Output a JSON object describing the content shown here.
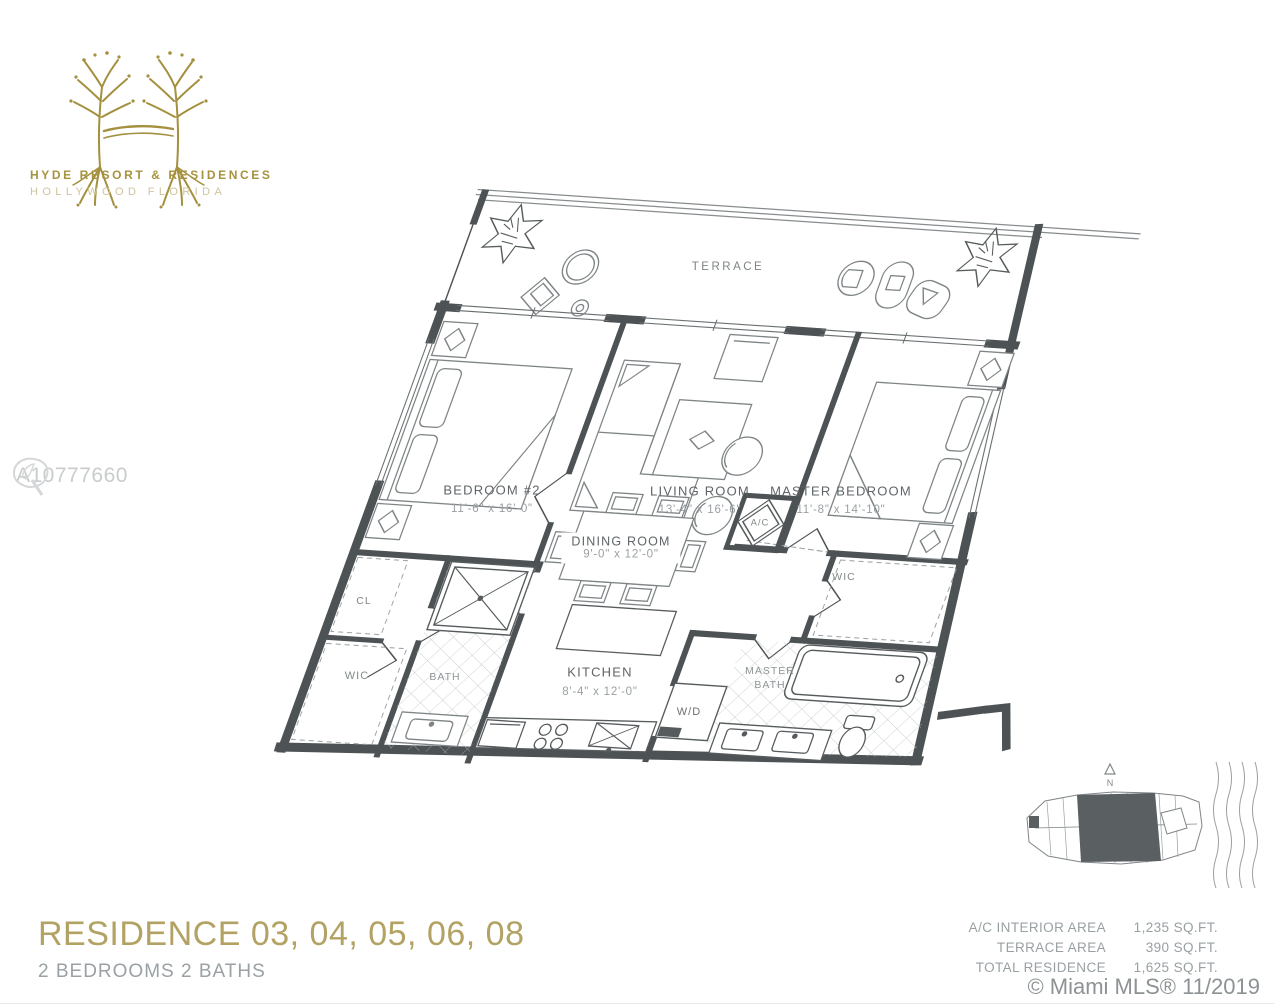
{
  "brand": {
    "line1": "HYDE RESORT & RESIDENCES",
    "line2": "HOLLYWOOD FLORIDA"
  },
  "watermark": {
    "id": "A10777660"
  },
  "plan": {
    "terrace": {
      "label": "TERRACE"
    },
    "bedroom2": {
      "label": "BEDROOM #2",
      "dims": "11'-6\" x 16'-0\""
    },
    "living": {
      "label": "LIVING ROOM",
      "dims": "13'-4\" x 16'-6\""
    },
    "master": {
      "label": "MASTER BEDROOM",
      "dims": "11'-8\" x 14'-10\""
    },
    "dining": {
      "label": "DINING ROOM",
      "dims": "9'-0\" x 12'-0\""
    },
    "kitchen": {
      "label": "KITCHEN",
      "dims": "8'-4\" x 12'-0\""
    },
    "cl": {
      "label": "CL"
    },
    "wic_left": {
      "label": "WIC"
    },
    "bath": {
      "label": "BATH"
    },
    "master_bath": {
      "line1": "MASTER",
      "line2": "BATH"
    },
    "wic_master": {
      "label": "WIC"
    },
    "ac": {
      "label": "A/C"
    },
    "wd": {
      "label": "W/D"
    }
  },
  "keyplan": {
    "north_label": "N"
  },
  "footer": {
    "title": "RESIDENCE 03, 04, 05, 06, 08",
    "subtitle": "2 BEDROOMS 2 BATHS",
    "areas": [
      {
        "label": "A/C INTERIOR AREA",
        "value": "1,235 SQ.FT."
      },
      {
        "label": "TERRACE AREA",
        "value": "390 SQ.FT."
      },
      {
        "label": "TOTAL RESIDENCE",
        "value": "1,625 SQ.FT."
      }
    ],
    "copyright": "© Miami MLS® 11/2019"
  },
  "colors": {
    "gold": "#a6923f",
    "gold_light": "#cfc49a",
    "title_gold": "#b2a263",
    "wall": "#4d5255",
    "furniture": "#7f8587",
    "label_gray": "#5f6568",
    "dim_gray": "#9aa0a2",
    "watermark_gray": "#c9cccd"
  }
}
